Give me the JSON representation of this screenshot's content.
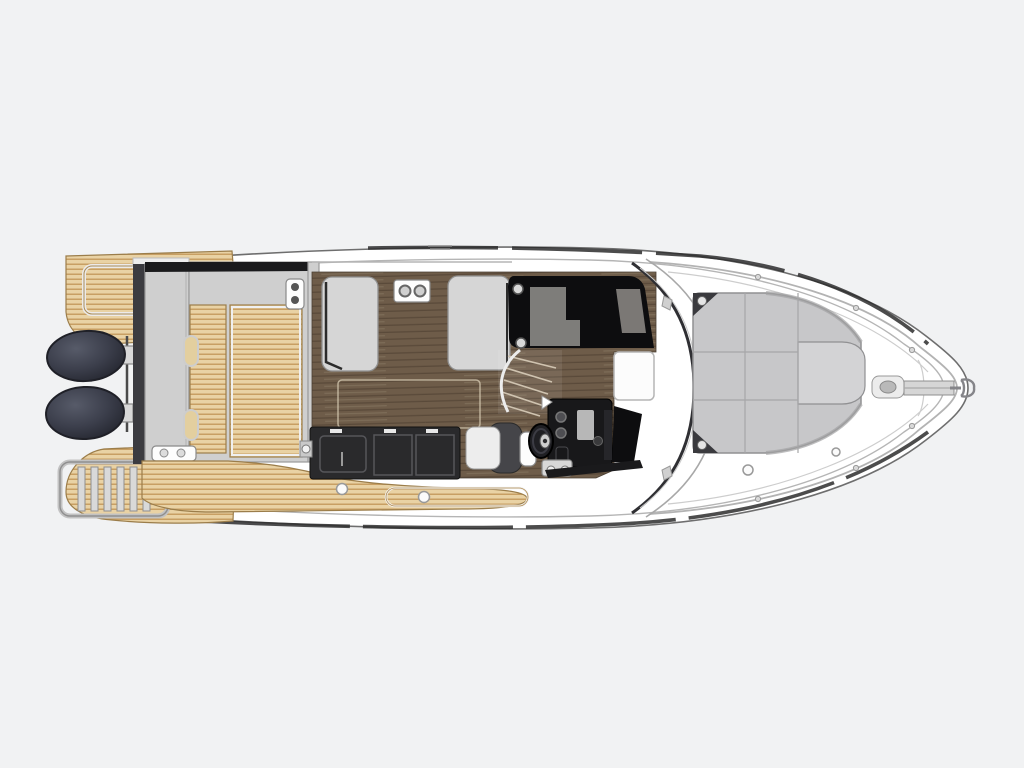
{
  "diagram": {
    "type": "boat-deck-plan",
    "view": "top-down",
    "orientation": "bow-right",
    "label": "Motor boat deck plan, top view, bow to the right"
  },
  "parts": [
    "hull",
    "swim-platform-port",
    "swim-platform-starboard",
    "boarding-ladder",
    "outboard-engine-1",
    "outboard-engine-2",
    "transom",
    "aft-cockpit",
    "cockpit-teak-hatch",
    "side-deck-walkway",
    "saloon-floor",
    "settee-port",
    "settee-starboard",
    "table-pedestal-plate",
    "galley-counter",
    "sink",
    "stove",
    "helm-companion-seat",
    "companionway-stairs",
    "sunroof-glass",
    "windshield",
    "helm-console",
    "steering-wheel",
    "foredeck-sunpad",
    "bow-rail",
    "windlass",
    "anchor-roller",
    "anchor"
  ],
  "colors": {
    "bg": "#f1f2f3",
    "hull-fill": "#ffffff",
    "hull-line": "#6e6e6e",
    "inner-line": "#b5b5b5",
    "rub-rail": "#2d2d2d",
    "teak": "#e9d2a4",
    "teak-line": "#c89f63",
    "teak-edge": "#9b7d4a",
    "deck-gray": "#cfcfcf",
    "deck-gray-edge": "#9a9a9a",
    "transom-dark": "#3b3b40",
    "wood": "#6e5c49",
    "wood-line": "#5a4a3a",
    "wood-light": "#80705b",
    "cushion": "#d6d6d6",
    "cushion-edge": "#8f8f8f",
    "black-trim": "#1a1a1c",
    "galley": "#2a2a2c",
    "galley-line": "#56565a",
    "glass": "#0d0d0f",
    "glass-reflect": "#8b8986",
    "glass-reflect2": "#7b7875",
    "engine-hi": "#575b69",
    "engine-mid": "#3c3f4c",
    "engine-dark": "#24262f",
    "pad": "#c7c7c9",
    "pad-raised": "#d3d3d5",
    "pad-line": "#a6a6a8",
    "pad-edge": "#909092",
    "pad-corner": "#3a3a3e",
    "metal": "#d8d8d8",
    "metal-edge": "#8a8a8a",
    "white": "#fdfdfd",
    "rail": "#b3b3b3",
    "seam": "#cdcdcd"
  }
}
